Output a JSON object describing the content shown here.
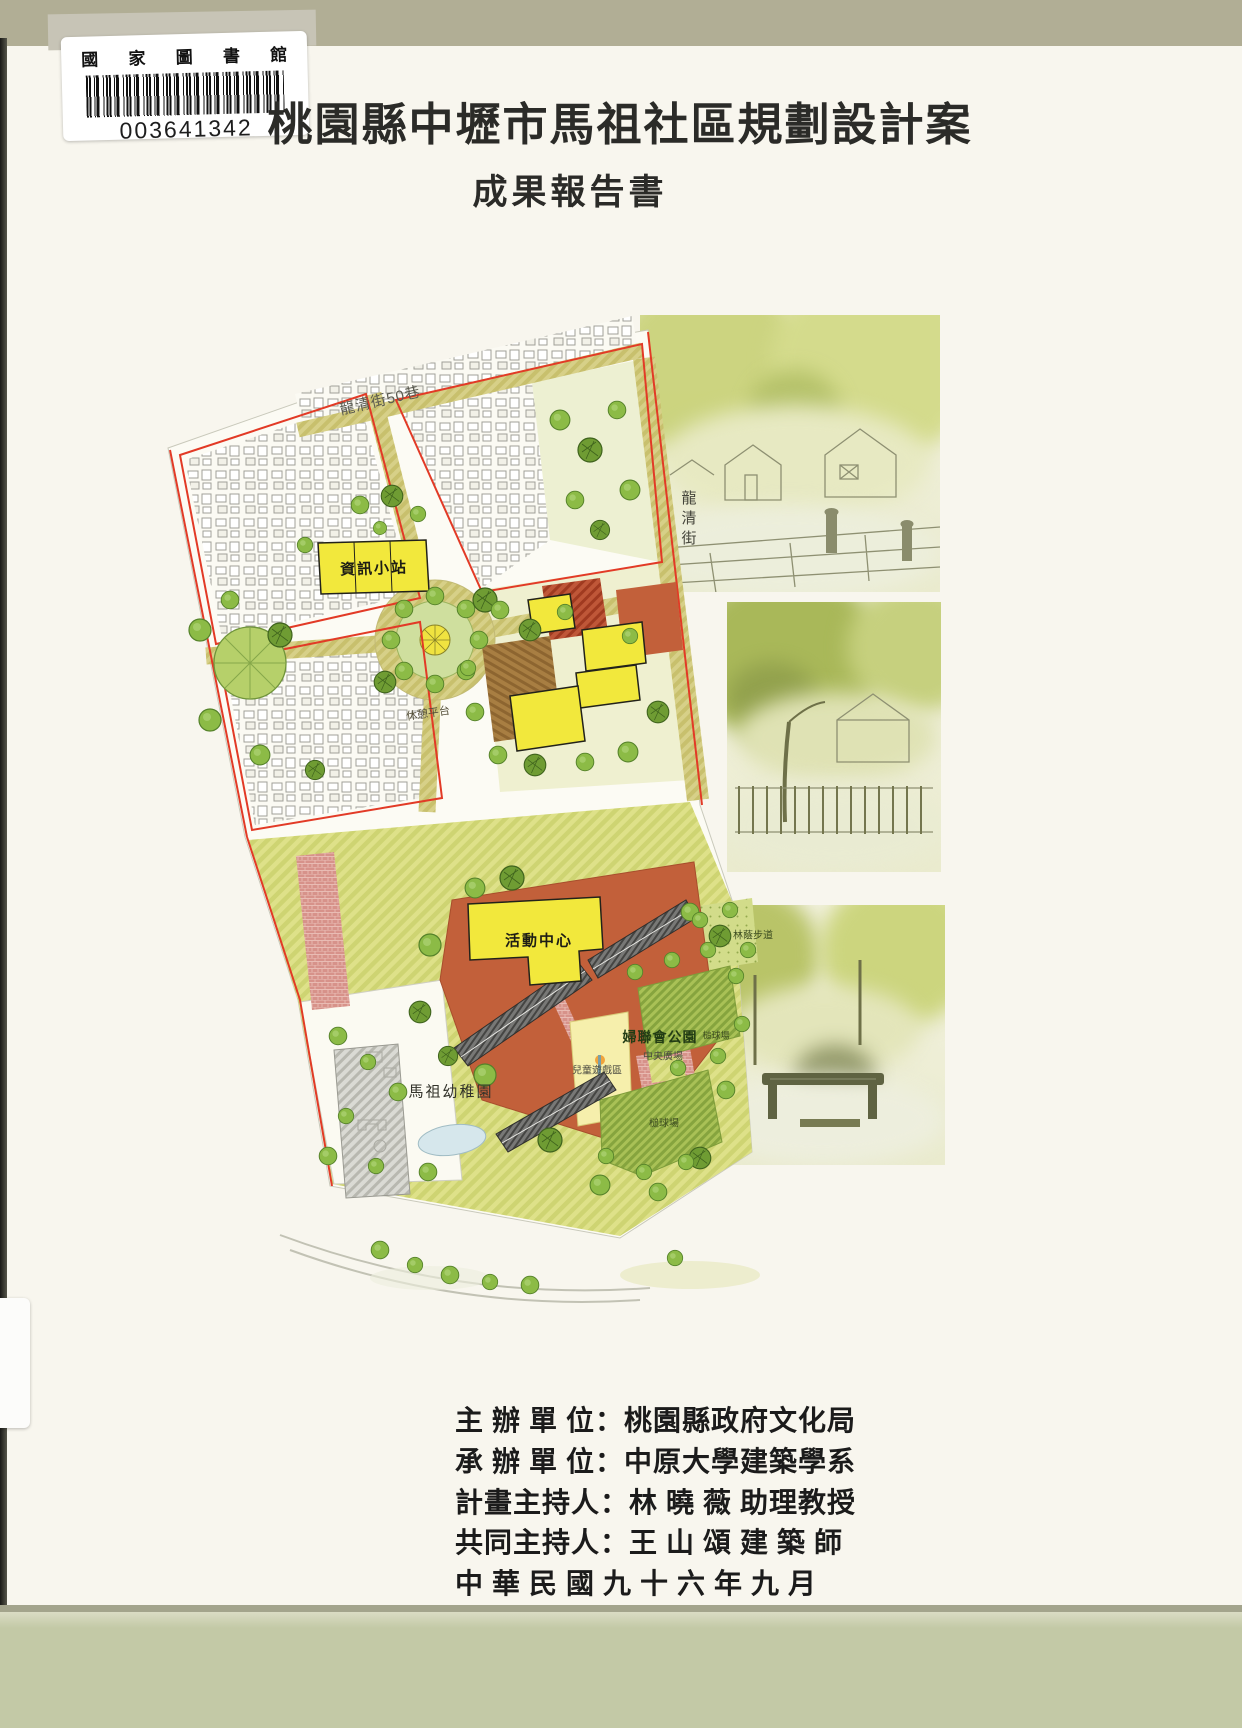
{
  "library_label": {
    "name": "國 家 圖 書 館",
    "barcode_number": "003641342"
  },
  "title": "桃園縣中壢市馬祖社區規劃設計案",
  "subtitle": "成果報告書",
  "site_plan": {
    "street_top": "龍清街50巷",
    "street_right": "龍清街",
    "labels": {
      "info_station": "資訊小站",
      "rest_platform": "休憩平台",
      "activity_center": "活動中心",
      "shaded_walkway": "林蔭步道",
      "womens_league_park": "婦聯會公園",
      "central_plaza": "中央廣場",
      "children_play_area": "兒童遊戲區",
      "gateball_court_upper": "槌球場",
      "gateball_court_lower": "槌球場",
      "mazu_kindergarten": "馬祖幼稚園"
    }
  },
  "credits": [
    "主 辦 單 位：桃園縣政府文化局",
    "承 辦 單 位：中原大學建築學系",
    "計畫主持人：林 曉 薇 助理教授",
    "共同主持人：王 山 頌 建 築 師",
    "中 華 民 國 九 十 六 年 九 月"
  ],
  "colors": {
    "cover_top_band": "#b1ae95",
    "cover_bottom_band": "#c3c9a6",
    "paper": "#f8f6ee",
    "street_khaki": "#d7d088",
    "tree_green": "#8cbb46",
    "building_yellow": "#f2e83c",
    "plaza_terracotta": "#c2603a",
    "boundary_red": "#e23a26",
    "path_pink": "#d7928a",
    "sketch_wash": "#c8d176"
  }
}
